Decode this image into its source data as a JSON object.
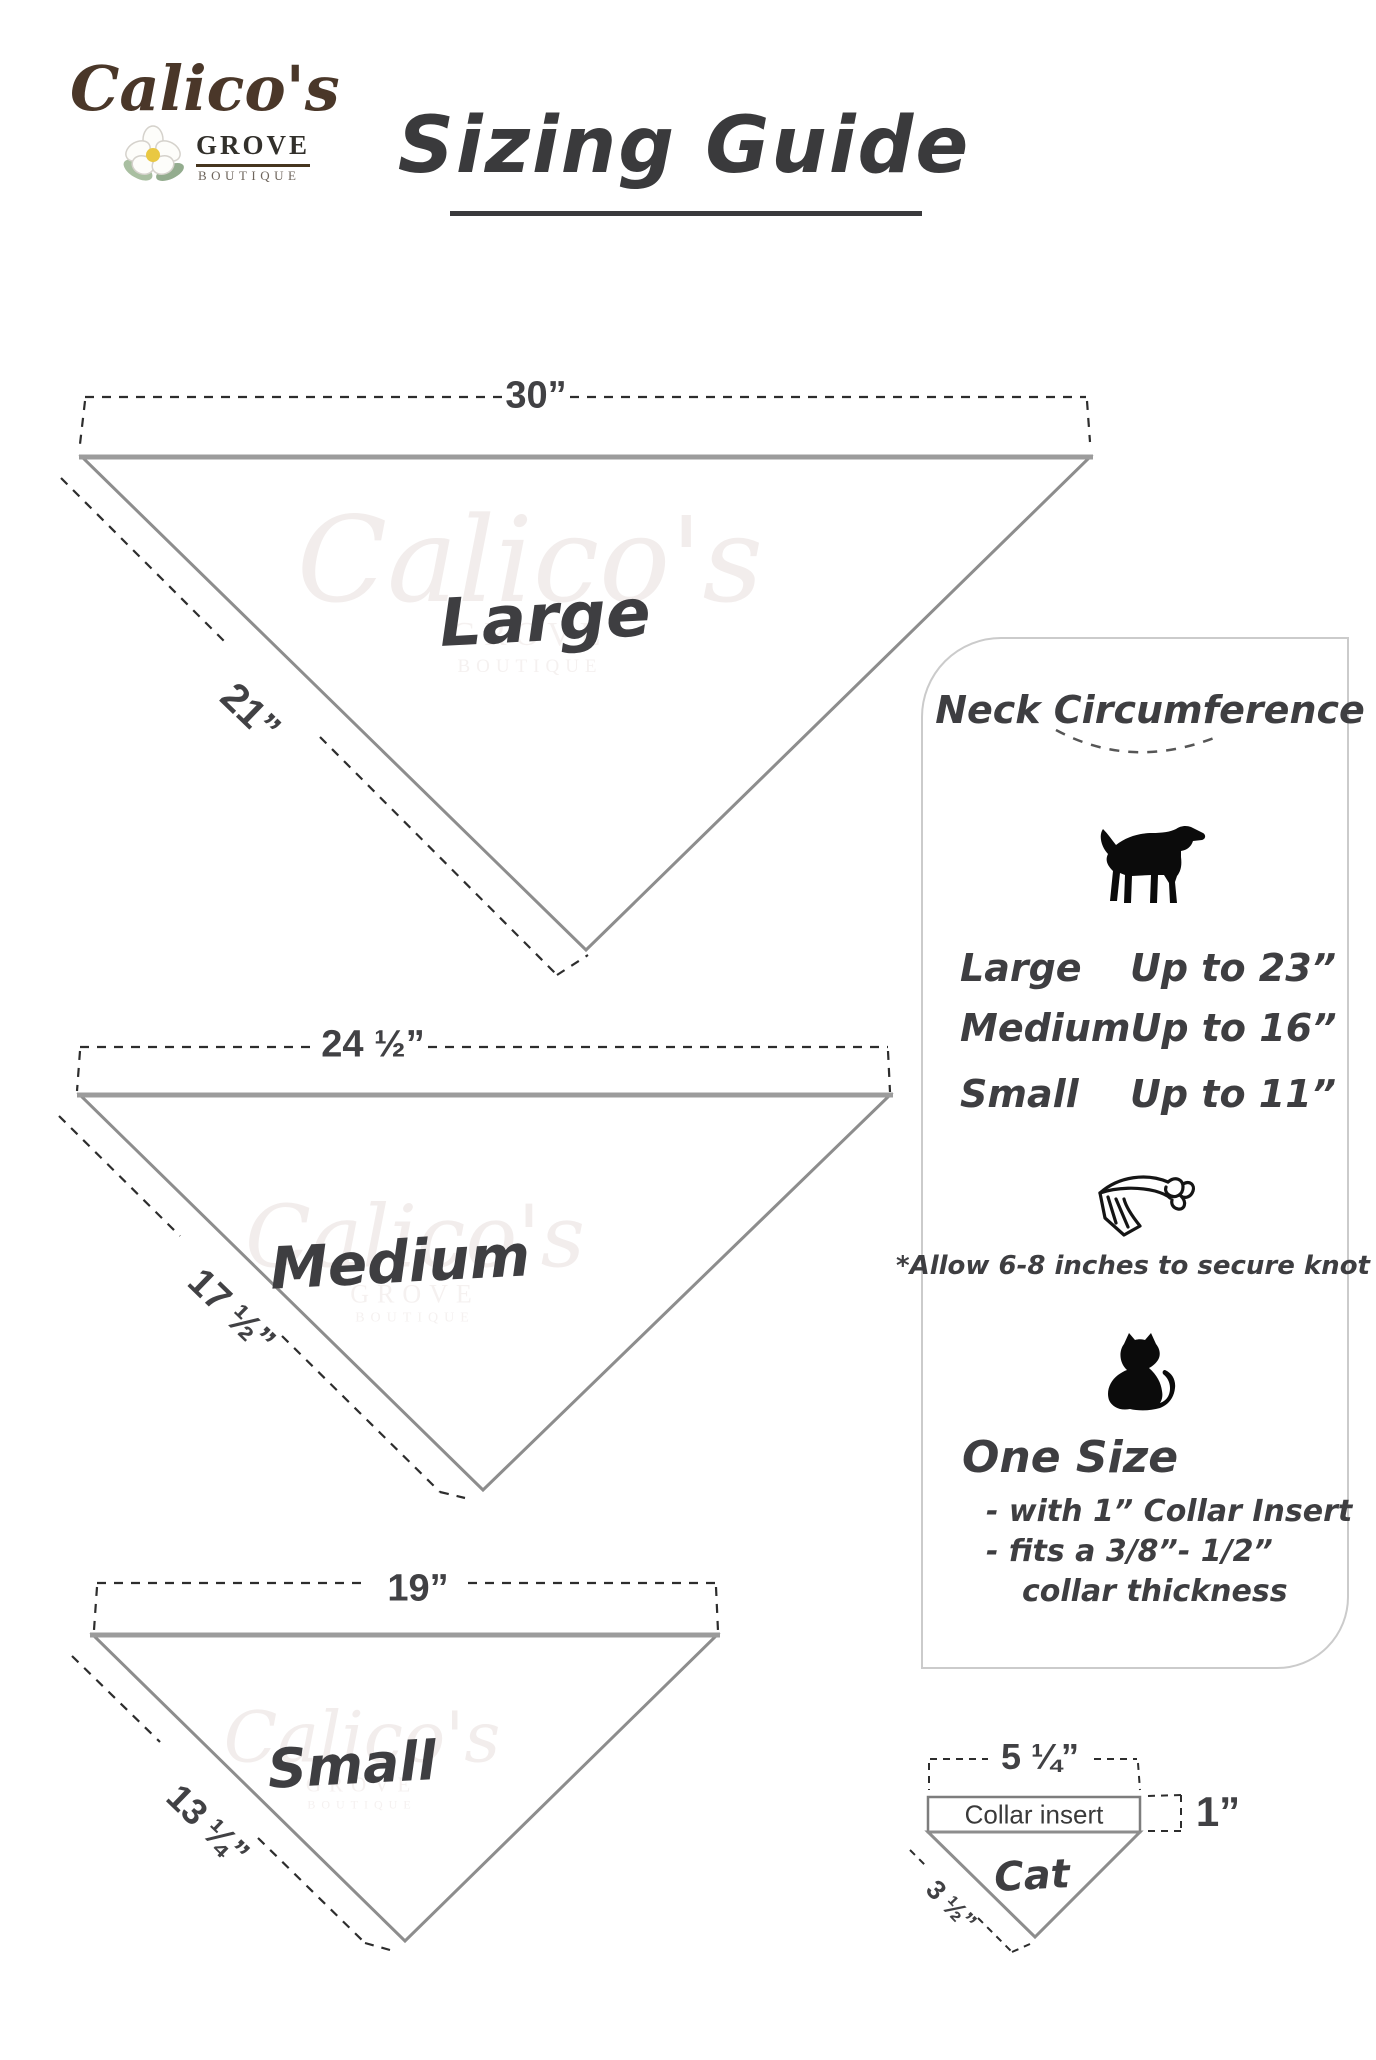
{
  "logo": {
    "name": "Calico's",
    "grove": "GROVE",
    "boutique": "BOUTIQUE"
  },
  "title": "Sizing Guide",
  "watermark": {
    "name": "Calico's",
    "grove": "GROVE",
    "boutique": "BOUTIQUE"
  },
  "sizes": {
    "large": {
      "label": "Large",
      "top_width": "30”",
      "side_length": "21”"
    },
    "medium": {
      "label": "Medium",
      "top_width": "24 ½”",
      "side_length": "17 ½”"
    },
    "small": {
      "label": "Small",
      "top_width": "19”",
      "side_length": "13 ¼”"
    }
  },
  "panel": {
    "heading": "Neck Circumference",
    "rows": [
      {
        "size": "Large",
        "value": "Up to 23”"
      },
      {
        "size": "Medium",
        "value": "Up to 16”"
      },
      {
        "size": "Small",
        "value": "Up to 11”"
      }
    ],
    "knot_note": "*Allow 6-8 inches to secure knot",
    "one_size": {
      "heading": "One Size",
      "line1": "- with 1” Collar Insert",
      "line2": "- fits a 3/8”- 1/2”",
      "line3": "collar thickness"
    }
  },
  "cat_diagram": {
    "label": "Cat",
    "collar_insert": "Collar insert",
    "top_width": "5 ¼”",
    "insert_height": "1”",
    "side_length": "3 ½”"
  },
  "icons": {
    "dog": "dog-silhouette-icon",
    "bandana": "tied-bandana-icon",
    "cat": "cat-silhouette-icon",
    "flower": "magnolia-flower-icon"
  },
  "colors": {
    "triangle_stroke": "#8d8d8d",
    "triangle_top_stroke": "#9c9c9c",
    "dash": "#2d2d2d",
    "text_dark": "#3e3e41",
    "brand_brown": "#4a3729",
    "panel_border": "#cbcbcb",
    "watermark": "#f2edec"
  }
}
